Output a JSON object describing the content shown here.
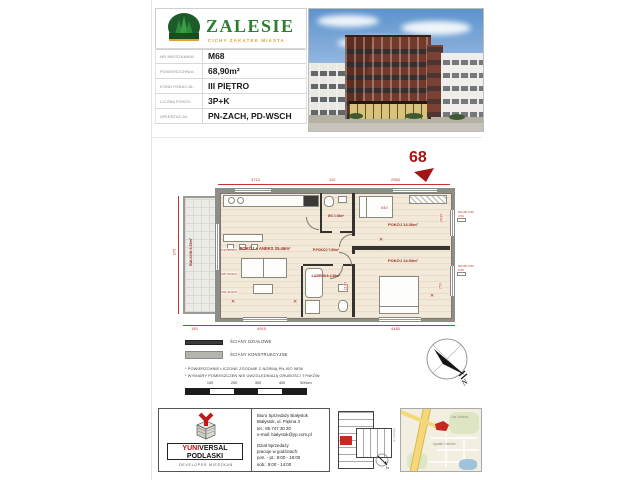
{
  "colors": {
    "brand_green": "#2f7d33",
    "accent_orange": "#dfa02f",
    "plan_red": "#c0392b",
    "logo_red": "#b01212"
  },
  "header": {
    "brand": {
      "name": "ZALESIE",
      "tagline": "CICHY ZAKĄTEK MIASTA"
    },
    "specs": [
      {
        "label": "NR MIESZKANIA:",
        "value": "M68"
      },
      {
        "label": "POWIERZCHNIA:",
        "value": "68,90m²"
      },
      {
        "label": "KONDYGNACJA:",
        "value": "III PIĘTRO"
      },
      {
        "label": "LICZBA POKOI:",
        "value": "3P+K"
      },
      {
        "label": "ORIENTACJA:",
        "value": "PN-ZACH, PD-WSCH"
      }
    ]
  },
  "plan": {
    "unit_number": "68",
    "rooms": [
      {
        "name": "BALKON 6.53m²"
      },
      {
        "name": "POKÓJ + ANEKS 25.46m²"
      },
      {
        "name": "WC 1.93m²"
      },
      {
        "name": "P.POKÓJ 7.69m²"
      },
      {
        "name": "POKÓJ 14.36m²"
      },
      {
        "name": "POKÓJ 14.93m²"
      },
      {
        "name": "ŁAZIENKA 4.38m²"
      }
    ],
    "dims": {
      "top1": "3713",
      "top2": "110",
      "top3": "2983",
      "bottom1": "150",
      "bottom2": "4915",
      "bottom3": "4485",
      "left1": "375",
      "inner1": "540",
      "inner2": "3635",
      "inner3": "250",
      "inner4": "1103"
    },
    "win_marks": {
      "l0": "O30 90/145",
      "l1": "O87 90/220",
      "l2": "O91 90/225",
      "r0": "90/150 O30 0.54",
      "r1": "90/150 O30 0.55"
    }
  },
  "legend": {
    "partition": "ŚCIANY DZIAŁOWE",
    "structural": "ŚCIANY KONSTRUKCYJNE",
    "note1": "* POWIERZCHNIE LICZONE ZGODNIE Z NORMĄ PN-ISO 9836",
    "note2": "* WYMIARY POMIESZCZEŃ NIE UWZGLĘDNIAJĄ GRUBOŚCI TYNKÓW"
  },
  "scalebar": {
    "t0": "100",
    "t1": "200",
    "t2": "300",
    "t3": "400",
    "t4": "500cm"
  },
  "compass": {
    "n": "N"
  },
  "footer": {
    "company": {
      "part1": "YUNI",
      "part2": "VERSAL",
      "line2": "PODLASKI",
      "tagline": "DEVELOPER MIESZKAŃ"
    },
    "office": {
      "l0": "Biuro Sprzedaży Białystok",
      "l1": "Białystok, ul. Piękna 3",
      "l2": "tel.: 85 747 30 30",
      "l3": "e-mail: bialystok@yp.com.pl"
    },
    "hours": {
      "l0": "Dział Sprzedaży",
      "l1": "pracuje w godzinach:",
      "l2": "pon. - pt.: 8:00 - 18:00",
      "l3": "sob.: 9:00 - 14:00"
    },
    "siteplan": {
      "street": "ul. Zacisze",
      "n": "N"
    },
    "map": {
      "label1": "Las Solnicki",
      "label2": "Ignatki-Osiedle"
    }
  }
}
